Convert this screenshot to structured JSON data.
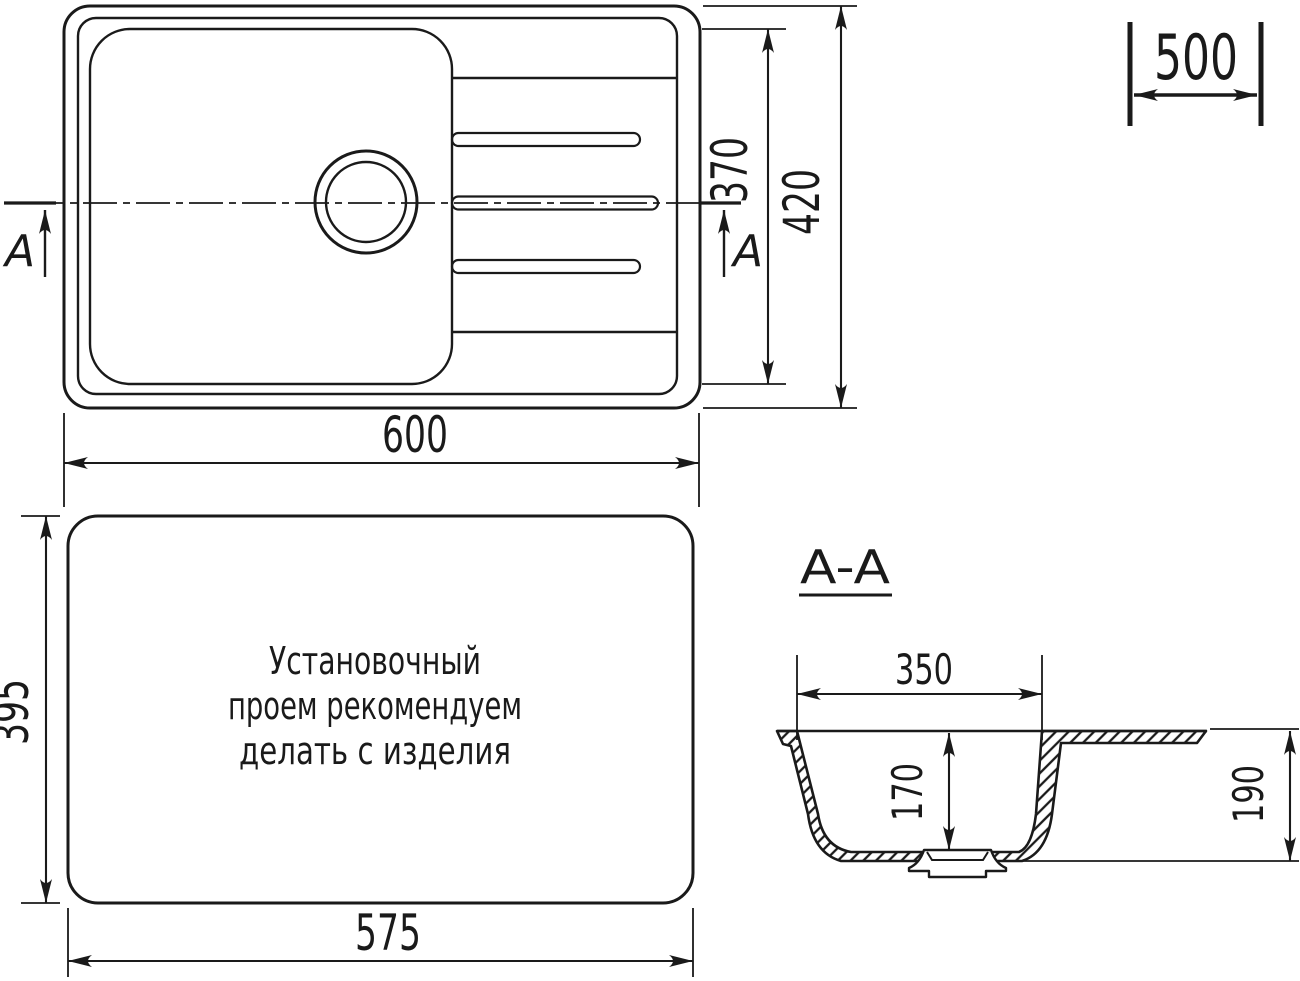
{
  "page": {
    "background": "#ffffff",
    "line_color": "#1a1a1a"
  },
  "top_view": {
    "width_label": "600",
    "overall_depth_label": "420",
    "bowl_depth_label": "370",
    "section_marker_left": "A",
    "section_marker_right": "A"
  },
  "brand_mark": {
    "label": "500"
  },
  "cutout_view": {
    "width_label": "575",
    "height_label": "395",
    "note": {
      "line1": "Установочный",
      "line2": "проем рекомендуем",
      "line3": "делать с изделия"
    }
  },
  "section_view": {
    "title": "A-A",
    "bowl_width_label": "350",
    "bowl_depth_label": "170",
    "overall_depth_label": "190"
  }
}
